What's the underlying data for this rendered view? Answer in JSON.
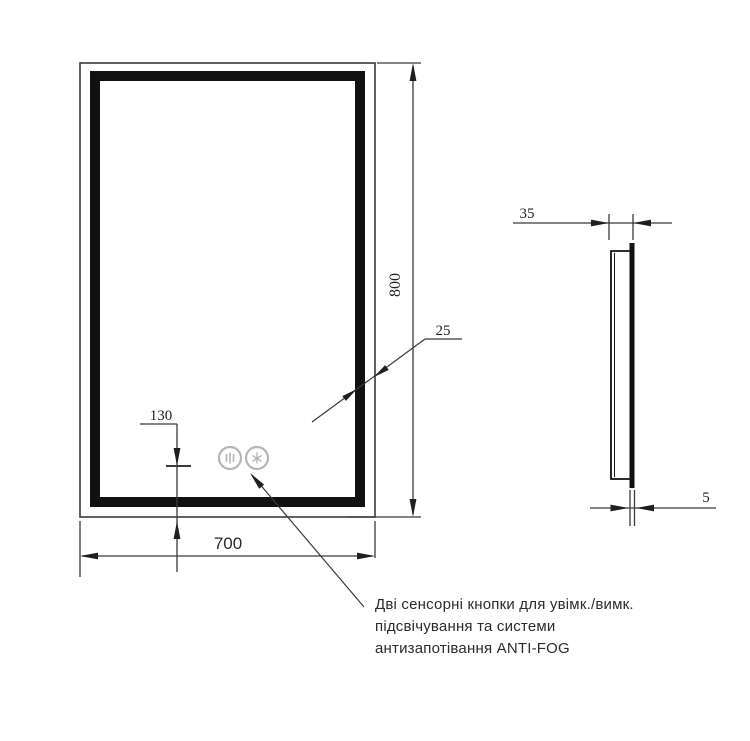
{
  "drawing": {
    "type": "technical-drawing",
    "subject": "LED mirror with touch buttons — front and side views",
    "dimensions": {
      "height_mm": "800",
      "width_mm": "700",
      "buttons_offset_mm": "130",
      "frame_band_mm": "25",
      "depth_mm": "35",
      "panel_thickness_mm": "5"
    },
    "annotation": {
      "line1": "Дві сенсорні кнопки для увімк./вимк.",
      "line2": "підсвічування та системи",
      "line3": "антизапотівання ANTI-FOG"
    },
    "icons": {
      "left_button": "backlight-touch-icon",
      "right_button": "antifog-touch-icon"
    },
    "colors": {
      "line": "#333333",
      "frame_fill": "#111111",
      "arrow_fill": "#1f1f1f",
      "button_gray": "#b5b5b5",
      "background": "#ffffff"
    }
  }
}
